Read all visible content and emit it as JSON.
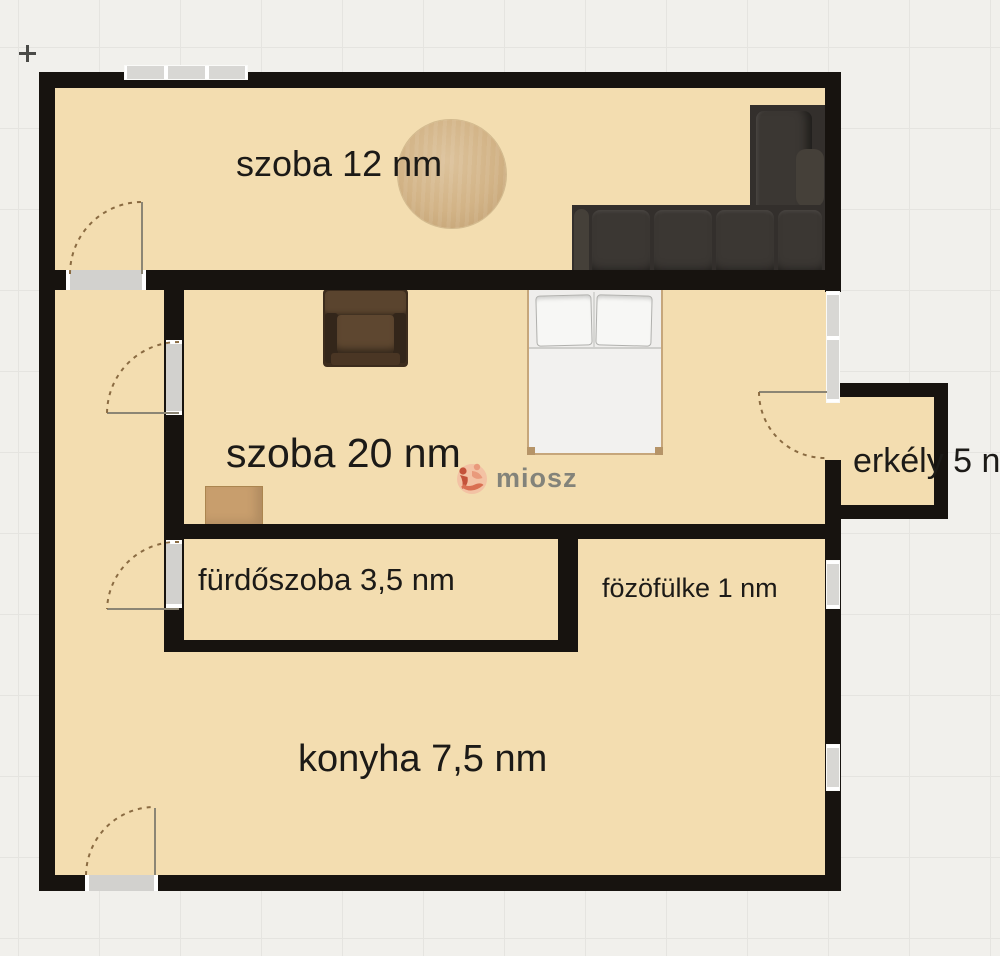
{
  "app": {
    "type": "floorplan-canvas",
    "background": "#f1f0ec",
    "grid_line_color": "#e5e4e0",
    "grid_spacing_px": 81
  },
  "cursor": {
    "icon": "plus-cursor",
    "color": "#4b4b48"
  },
  "watermark": {
    "text": "miosz",
    "icon": "miosz-logo-icon",
    "icon_colors": [
      "#f2bda2",
      "#c4523a",
      "#e99a7c",
      "#d96f52"
    ],
    "text_color": "#83837a"
  },
  "palette": {
    "floor": "#f3ddb0",
    "wall": "#17130f",
    "window": "#d8d7d4",
    "door_opening": "#d2d1ce",
    "door_arc": "#8a6b42",
    "label_text": "#1c1a17",
    "sofa": "#332f2c",
    "armchair": "#3c2c1d",
    "table_wood": "#d2b386",
    "bed_frame": "#c6a67b",
    "bed_linen": "#efeeec",
    "side_table": "#c89e6d"
  },
  "rooms": {
    "szoba12": {
      "name": "szoba",
      "area": "12 nm",
      "label": "szoba 12 nm"
    },
    "szoba20": {
      "name": "szoba",
      "area": "20 nm",
      "label": "szoba 20 nm"
    },
    "erkely": {
      "name": "erkély",
      "area": "5 nm",
      "label": "erkély 5 nm"
    },
    "furdoszoba": {
      "name": "fürdőszoba",
      "area": "3,5 nm",
      "label": "fürdőszoba 3,5 nm"
    },
    "fozofulke": {
      "name": "fözöfülke",
      "area": "1 nm",
      "label": "fözöfülke 1 nm"
    },
    "konyha": {
      "name": "konyha",
      "area": "7,5 nm",
      "label": "konyha 7,5 nm"
    }
  },
  "furniture": [
    {
      "name": "round-dining-table",
      "room": "szoba 12 nm"
    },
    {
      "name": "corner-sofa",
      "room": "szoba 12 nm"
    },
    {
      "name": "armchair",
      "room": "szoba 20 nm"
    },
    {
      "name": "double-bed",
      "room": "szoba 20 nm"
    },
    {
      "name": "side-table",
      "room": "szoba 20 nm"
    }
  ],
  "openings": {
    "doors": [
      "szoba12-door",
      "szoba20-door",
      "furdoszoba-door",
      "konyha-entry-door",
      "erkely-door"
    ],
    "windows": [
      "szoba12-top-window",
      "erkely-glazed-panel",
      "fozofulke-window",
      "konyha-window"
    ]
  }
}
